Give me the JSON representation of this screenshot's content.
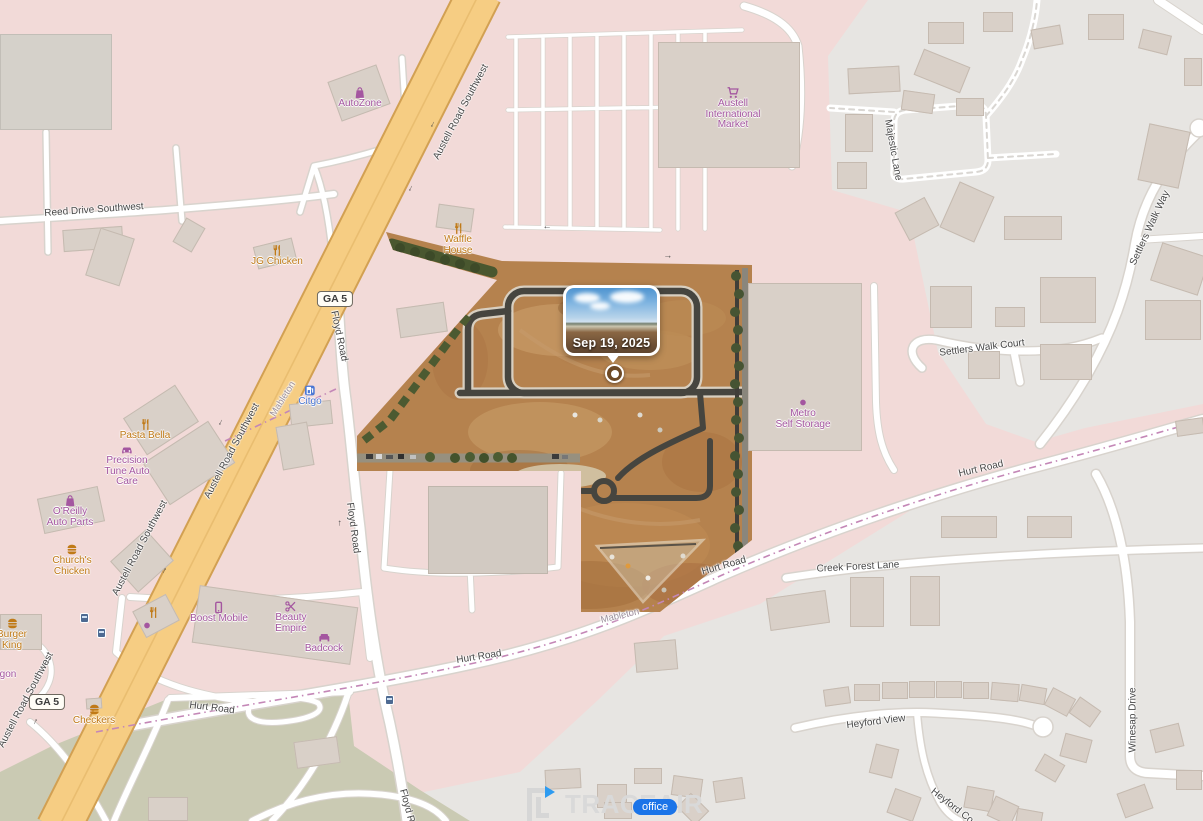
{
  "branding": {
    "logo_text": "TRACEAIR",
    "office_label": "office"
  },
  "site": {
    "popup": {
      "date": "Sep 19, 2025"
    }
  },
  "map": {
    "colors": {
      "landuse_pink": "#f2dad8",
      "landuse_gray": "#e7e5e2",
      "landuse_olive": "#cacab3",
      "building": "#d9d0c8",
      "major_road": "#f6cd83",
      "major_road_casing": "#d2a052",
      "boundary_dash": "#c487b7",
      "poi_purple": "#a456a0",
      "poi_orange": "#c07a17",
      "poi_blue": "#4a77d4",
      "site_dirt": "#b5824e",
      "office_chip": "#1b74e8"
    },
    "shields": [
      {
        "t": "GA 5",
        "x": 335,
        "y": 299
      },
      {
        "t": "GA 5",
        "x": 47,
        "y": 702
      }
    ],
    "road_labels": [
      {
        "t": "Reed Drive Southwest",
        "x": 94,
        "y": 210,
        "r": -4
      },
      {
        "t": "Austell Road Southwest",
        "x": 461,
        "y": 112,
        "r": -62
      },
      {
        "t": "Austell Road Southwest",
        "x": 232,
        "y": 451,
        "r": -62
      },
      {
        "t": "Austell Road Southwest",
        "x": 140,
        "y": 548,
        "r": -62
      },
      {
        "t": "Austell Road Southwest",
        "x": 26,
        "y": 700,
        "r": -62
      },
      {
        "t": "Floyd Road",
        "x": 339,
        "y": 336,
        "r": 78
      },
      {
        "t": "Floyd Road",
        "x": 353,
        "y": 528,
        "r": 82
      },
      {
        "t": "Floyd Road",
        "x": 409,
        "y": 814,
        "r": 75
      },
      {
        "t": "Hurt Road",
        "x": 981,
        "y": 469,
        "r": -13
      },
      {
        "t": "Hurt Road",
        "x": 724,
        "y": 566,
        "r": -16
      },
      {
        "t": "Hurt Road",
        "x": 479,
        "y": 657,
        "r": -9
      },
      {
        "t": "Hurt Road",
        "x": 212,
        "y": 708,
        "r": 7
      },
      {
        "t": "Creek Forest Lane",
        "x": 858,
        "y": 567,
        "r": -3
      },
      {
        "t": "Settlers Walk Way",
        "x": 1150,
        "y": 228,
        "r": -65
      },
      {
        "t": "Settlers Walk Court",
        "x": 982,
        "y": 348,
        "r": -7
      },
      {
        "t": "Majestic Lane",
        "x": 893,
        "y": 150,
        "r": 80
      },
      {
        "t": "Heyford View",
        "x": 876,
        "y": 722,
        "r": -7
      },
      {
        "t": "Heyford Co",
        "x": 952,
        "y": 806,
        "r": 38
      },
      {
        "t": "Winesap Drive",
        "x": 1133,
        "y": 720,
        "r": -90
      },
      {
        "t": "Mableton",
        "x": 283,
        "y": 399,
        "r": -58,
        "c": "#9b8f9b",
        "s": 9.5
      },
      {
        "t": "Mableton",
        "x": 620,
        "y": 616,
        "r": -13,
        "c": "#9b8f9b",
        "s": 9.5
      }
    ],
    "pois": [
      {
        "x": 360,
        "y": 86,
        "icon": "shop",
        "color": "#a456a0",
        "lines": [
          "AutoZone"
        ]
      },
      {
        "x": 458,
        "y": 222,
        "icon": "restaurant",
        "color": "#c07a17",
        "lines": [
          "Waffle",
          "House"
        ]
      },
      {
        "x": 733,
        "y": 86,
        "icon": "cart",
        "color": "#a456a0",
        "lines": [
          "Austell",
          "International",
          "Market"
        ]
      },
      {
        "x": 277,
        "y": 244,
        "icon": "restaurant",
        "color": "#c07a17",
        "lines": [
          "JG Chicken"
        ]
      },
      {
        "x": 310,
        "y": 384,
        "icon": "fuel",
        "color": "#4a77d4",
        "lines": [
          "Citgo"
        ],
        "lc": "#4a77d4"
      },
      {
        "x": 145,
        "y": 418,
        "icon": "restaurant",
        "color": "#c07a17",
        "lines": [
          "Pasta Bella"
        ]
      },
      {
        "x": 127,
        "y": 443,
        "icon": "car",
        "color": "#a456a0",
        "lines": [
          "Precision",
          "Tune Auto",
          "Care"
        ]
      },
      {
        "x": 70,
        "y": 494,
        "icon": "shop",
        "color": "#a456a0",
        "lines": [
          "O'Reilly",
          "Auto Parts"
        ]
      },
      {
        "x": 72,
        "y": 543,
        "icon": "fastfood",
        "color": "#c07a17",
        "lines": [
          "Church's",
          "Chicken"
        ]
      },
      {
        "x": 219,
        "y": 601,
        "icon": "phone",
        "color": "#a456a0",
        "lines": [
          "Boost Mobile"
        ]
      },
      {
        "x": 291,
        "y": 600,
        "icon": "hair",
        "color": "#a456a0",
        "lines": [
          "Beauty",
          "Empire"
        ]
      },
      {
        "x": 324,
        "y": 631,
        "icon": "sofa",
        "color": "#a456a0",
        "lines": [
          "Badcock"
        ]
      },
      {
        "x": 12,
        "y": 617,
        "icon": "fastfood",
        "color": "#c07a17",
        "lines": [
          "Burger",
          "King"
        ]
      },
      {
        "x": 94,
        "y": 703,
        "icon": "fastfood",
        "color": "#c07a17",
        "lines": [
          "Checkers"
        ]
      },
      {
        "x": 803,
        "y": 396,
        "icon": "dot",
        "color": "#a456a0",
        "lines": [
          "Metro",
          "Self Storage"
        ]
      },
      {
        "x": 8,
        "y": 670,
        "icon": "none",
        "color": "#a456a0",
        "lines": [
          "gon"
        ]
      },
      {
        "x": 153,
        "y": 606,
        "icon": "restaurant",
        "color": "#c07a17",
        "lines": []
      },
      {
        "x": 147,
        "y": 619,
        "icon": "dot",
        "color": "#a456a0",
        "lines": []
      }
    ],
    "buildings": [
      [
        0,
        34,
        112,
        96,
        0,
        "g"
      ],
      [
        333,
        72,
        52,
        42,
        -20,
        ""
      ],
      [
        658,
        42,
        142,
        126,
        0,
        ""
      ],
      [
        63,
        228,
        60,
        22,
        -4,
        ""
      ],
      [
        92,
        232,
        36,
        50,
        18,
        ""
      ],
      [
        178,
        221,
        22,
        28,
        30,
        ""
      ],
      [
        437,
        206,
        36,
        24,
        8,
        ""
      ],
      [
        255,
        242,
        40,
        23,
        -14,
        ""
      ],
      [
        398,
        305,
        48,
        30,
        -8,
        ""
      ],
      [
        130,
        398,
        62,
        44,
        -33,
        ""
      ],
      [
        150,
        438,
        78,
        50,
        -33,
        ""
      ],
      [
        40,
        492,
        62,
        36,
        -12,
        ""
      ],
      [
        118,
        540,
        48,
        42,
        -42,
        ""
      ],
      [
        290,
        402,
        42,
        24,
        -6,
        ""
      ],
      [
        279,
        424,
        32,
        44,
        -10,
        ""
      ],
      [
        195,
        596,
        160,
        58,
        8,
        ""
      ],
      [
        137,
        601,
        38,
        30,
        -28,
        ""
      ],
      [
        0,
        614,
        42,
        36,
        0,
        ""
      ],
      [
        86,
        698,
        16,
        11,
        -4,
        ""
      ],
      [
        748,
        283,
        114,
        168,
        0,
        ""
      ],
      [
        428,
        486,
        120,
        88,
        0,
        "g2"
      ],
      [
        148,
        797,
        40,
        24,
        0,
        ""
      ],
      [
        295,
        739,
        44,
        27,
        -8,
        ""
      ],
      [
        545,
        769,
        36,
        20,
        -3,
        ""
      ],
      [
        597,
        784,
        30,
        24,
        0,
        ""
      ],
      [
        604,
        802,
        28,
        17,
        0,
        ""
      ],
      [
        634,
        768,
        28,
        16,
        0,
        ""
      ],
      [
        672,
        777,
        30,
        20,
        8,
        ""
      ],
      [
        680,
        799,
        26,
        20,
        45,
        ""
      ],
      [
        714,
        779,
        30,
        22,
        -8,
        ""
      ],
      [
        928,
        22,
        36,
        22,
        0,
        ""
      ],
      [
        983,
        12,
        30,
        20,
        0,
        ""
      ],
      [
        1032,
        27,
        30,
        20,
        -10,
        ""
      ],
      [
        1088,
        14,
        36,
        26,
        0,
        ""
      ],
      [
        1140,
        32,
        30,
        20,
        14,
        ""
      ],
      [
        1184,
        58,
        18,
        28,
        0,
        ""
      ],
      [
        902,
        92,
        32,
        20,
        8,
        ""
      ],
      [
        956,
        98,
        28,
        18,
        0,
        ""
      ],
      [
        848,
        67,
        52,
        26,
        -3,
        ""
      ],
      [
        845,
        114,
        28,
        38,
        0,
        ""
      ],
      [
        837,
        162,
        30,
        27,
        0,
        ""
      ],
      [
        917,
        57,
        50,
        28,
        22,
        ""
      ],
      [
        1143,
        127,
        42,
        58,
        12,
        ""
      ],
      [
        900,
        203,
        34,
        32,
        -28,
        ""
      ],
      [
        948,
        187,
        38,
        50,
        24,
        ""
      ],
      [
        1004,
        216,
        58,
        24,
        0,
        ""
      ],
      [
        930,
        286,
        42,
        42,
        0,
        ""
      ],
      [
        1040,
        277,
        56,
        46,
        0,
        ""
      ],
      [
        995,
        307,
        30,
        20,
        0,
        ""
      ],
      [
        968,
        351,
        32,
        28,
        0,
        ""
      ],
      [
        1040,
        344,
        52,
        36,
        0,
        ""
      ],
      [
        1155,
        249,
        50,
        40,
        18,
        ""
      ],
      [
        1145,
        300,
        56,
        40,
        0,
        ""
      ],
      [
        1176,
        419,
        28,
        16,
        -8,
        ""
      ],
      [
        768,
        594,
        60,
        33,
        -8,
        ""
      ],
      [
        850,
        577,
        34,
        50,
        0,
        ""
      ],
      [
        910,
        576,
        30,
        50,
        0,
        ""
      ],
      [
        941,
        516,
        56,
        22,
        0,
        ""
      ],
      [
        1027,
        516,
        45,
        22,
        0,
        ""
      ],
      [
        635,
        641,
        42,
        30,
        -5,
        ""
      ],
      [
        824,
        688,
        26,
        17,
        -8,
        ""
      ],
      [
        854,
        684,
        26,
        17,
        0,
        ""
      ],
      [
        882,
        682,
        26,
        17,
        0,
        ""
      ],
      [
        909,
        681,
        26,
        17,
        0,
        ""
      ],
      [
        936,
        681,
        26,
        17,
        0,
        ""
      ],
      [
        963,
        682,
        26,
        17,
        0,
        ""
      ],
      [
        991,
        683,
        28,
        18,
        5,
        ""
      ],
      [
        1020,
        686,
        26,
        17,
        10,
        ""
      ],
      [
        1047,
        692,
        26,
        20,
        28,
        ""
      ],
      [
        1072,
        702,
        26,
        20,
        35,
        ""
      ],
      [
        872,
        746,
        24,
        30,
        14,
        ""
      ],
      [
        890,
        792,
        28,
        26,
        20,
        ""
      ],
      [
        965,
        788,
        28,
        22,
        10,
        ""
      ],
      [
        990,
        800,
        26,
        22,
        25,
        ""
      ],
      [
        1016,
        810,
        26,
        18,
        10,
        ""
      ],
      [
        1038,
        758,
        24,
        20,
        30,
        ""
      ],
      [
        1062,
        736,
        28,
        24,
        15,
        ""
      ],
      [
        1120,
        788,
        30,
        26,
        -20,
        ""
      ],
      [
        1152,
        726,
        30,
        24,
        -14,
        ""
      ],
      [
        1176,
        770,
        26,
        20,
        0,
        ""
      ]
    ],
    "arrows": [
      [
        434,
        125,
        117
      ],
      [
        412,
        189,
        117
      ],
      [
        222,
        423,
        117
      ],
      [
        163,
        570,
        -63
      ],
      [
        50,
        661,
        117
      ],
      [
        34,
        721,
        -63
      ],
      [
        344,
        359,
        -85
      ],
      [
        338,
        523,
        -85
      ],
      [
        547,
        229,
        185
      ],
      [
        668,
        255,
        5
      ]
    ],
    "bus_stops": [
      [
        80,
        613
      ],
      [
        97,
        628
      ],
      [
        385,
        695
      ]
    ]
  }
}
